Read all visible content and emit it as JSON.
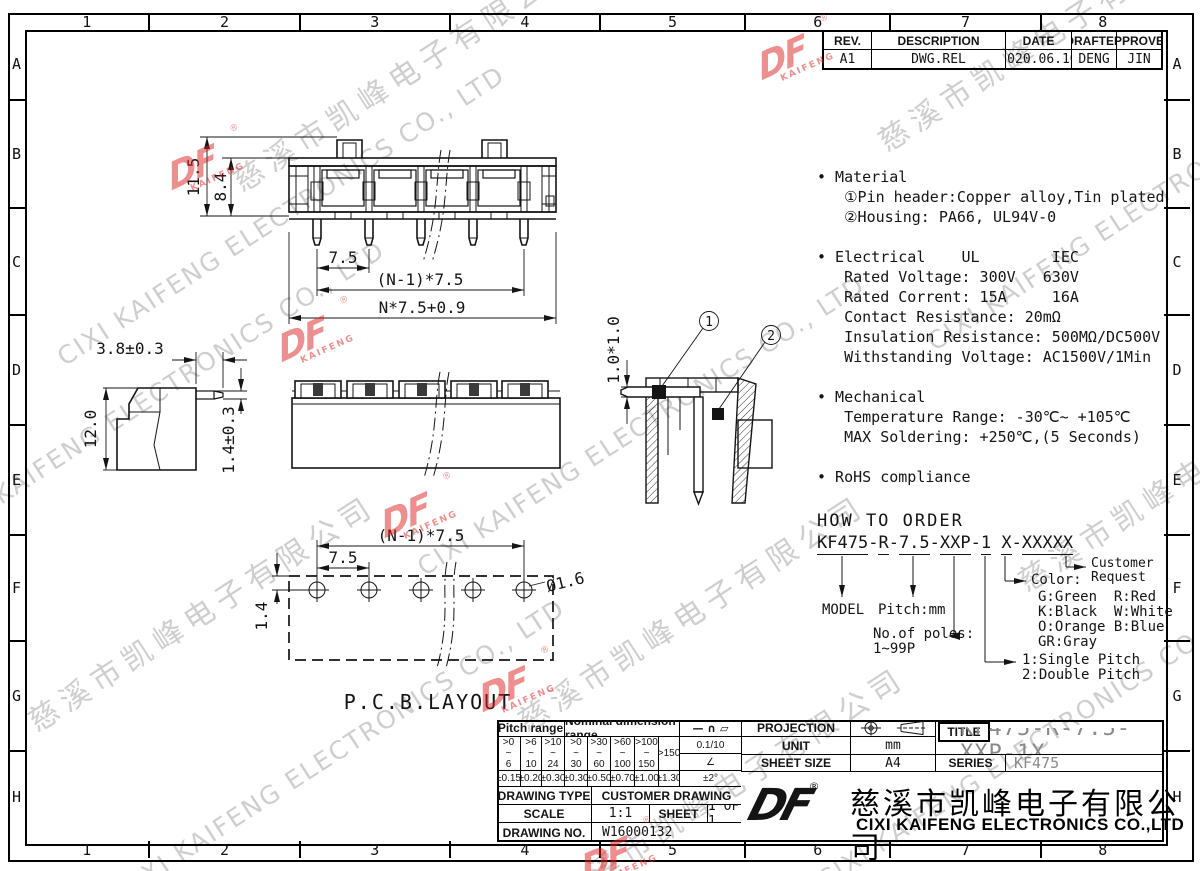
{
  "sheet": {
    "border_cols": [
      "1",
      "2",
      "3",
      "4",
      "5",
      "6",
      "7",
      "8"
    ],
    "border_rows": [
      "A",
      "B",
      "C",
      "D",
      "E",
      "F",
      "G",
      "H"
    ]
  },
  "rev_table": {
    "headers": [
      "REV.",
      "DESCRIPTION",
      "DATE",
      "DRAFTER",
      "APPROVER"
    ],
    "row": [
      "A1",
      "DWG.REL",
      "2020.06.10",
      "DENG",
      "JIN"
    ]
  },
  "notes": {
    "block": "• Material\n   ①Pin header:Copper alloy,Tin plated\n   ②Housing: PA66, UL94V-0\n\n• Electrical    UL        IEC\n   Rated Voltage: 300V   630V\n   Rated Corrent: 15A     16A\n   Contact Resistance: 20mΩ\n   Insulation Resistance: 500MΩ/DC500V\n   Withstanding Voltage: AC1500V/1Min\n\n• Mechanical\n   Temperature Range: -30℃~ +105℃\n   MAX Soldering: +250℃,(5 Seconds)\n\n• RoHS compliance"
  },
  "views": {
    "front": {
      "dim_height_total": "11.5",
      "dim_height_body": "8.4",
      "dim_pitch": "7.5",
      "dim_span": "(N-1)*7.5",
      "dim_total": "N*7.5+0.9"
    },
    "side": {
      "dim_depth": "3.8±0.3",
      "dim_height": "12.0",
      "dim_pin": "1.4±0.3"
    },
    "section": {
      "dim_pin_square": "1.0*1.0",
      "callout_1": "1",
      "callout_2": "2"
    },
    "pcb": {
      "dim_span": "(N-1)*7.5",
      "dim_pitch": "7.5",
      "dim_edge": "1.4",
      "dim_hole": "Ø1.6",
      "caption": "P.C.B.LAYOUT"
    }
  },
  "order": {
    "title": "HOW TO ORDER",
    "segments": [
      "KF475",
      "-",
      "R",
      "-",
      "7.5",
      "-",
      "XXP",
      "-",
      "1",
      " ",
      "X",
      "-",
      "XXXXX"
    ],
    "model": "MODEL",
    "pitch": "Pitch:mm",
    "poles_label": "No.of poles:",
    "poles_range": "1~99P",
    "single": "1:Single Pitch",
    "double": "2:Double Pitch",
    "color_label": "Color:",
    "color_rows": [
      "G:Green  R:Red",
      "K:Black  W:White",
      "O:Orange B:Blue",
      "GR:Gray"
    ],
    "customer_line1": "Customer",
    "customer_line2": "Request"
  },
  "tol_table": {
    "pitch_header": "Pitch range",
    "nominal_header": "Nominal dimension range",
    "symbols": "— ∩ ▱",
    "ranges": [
      ">0\n~\n6",
      ">6\n~\n10",
      ">10\n~\n24",
      ">0\n~\n30",
      ">30\n~\n60",
      ">60\n~\n100",
      ">100\n~\n150"
    ],
    "range_150": ">150",
    "tols": [
      "±0.15",
      "±0.20",
      "±0.30",
      "±0.30",
      "±0.50",
      "±0.70",
      "±1.00"
    ],
    "tol_150": "±1.30",
    "flatness": "0.1/10",
    "angle_symbol": "∠",
    "angle_tol": "±2°"
  },
  "admin": {
    "drawing_type_label": "DRAWING TYPE",
    "drawing_type": "CUSTOMER DRAWING",
    "scale_label": "SCALE",
    "scale": "1:1",
    "sheet_label": "SHEET",
    "sheet": "1 OF 1",
    "drawing_no_label": "DRAWING NO.",
    "drawing_no": "W16000132"
  },
  "info": {
    "projection_label": "PROJECTION",
    "unit_label": "UNIT",
    "unit_value": "mm",
    "sheet_size_label": "SHEET SIZE",
    "sheet_size_value": "A4",
    "title_label": "TITLE",
    "title_value": "KF475-R-7.5-XXP-1X",
    "series_label": "SERIES",
    "series_value": "KF475"
  },
  "company": {
    "logo_text": "DF",
    "registered_mark": "®",
    "name_cn": "慈溪市凯峰电子有限公司",
    "name_en": "CIXI KAIFENG ELECTRONICS CO.,LTD"
  },
  "watermark": {
    "cn": "慈溪市凯峰电子有限公司",
    "en": "CIXI KAIFENG ELECTRONICS CO., LTD",
    "stamp_main": "DF",
    "stamp_sub": "KAIFENG",
    "stamp_reg": "®"
  }
}
